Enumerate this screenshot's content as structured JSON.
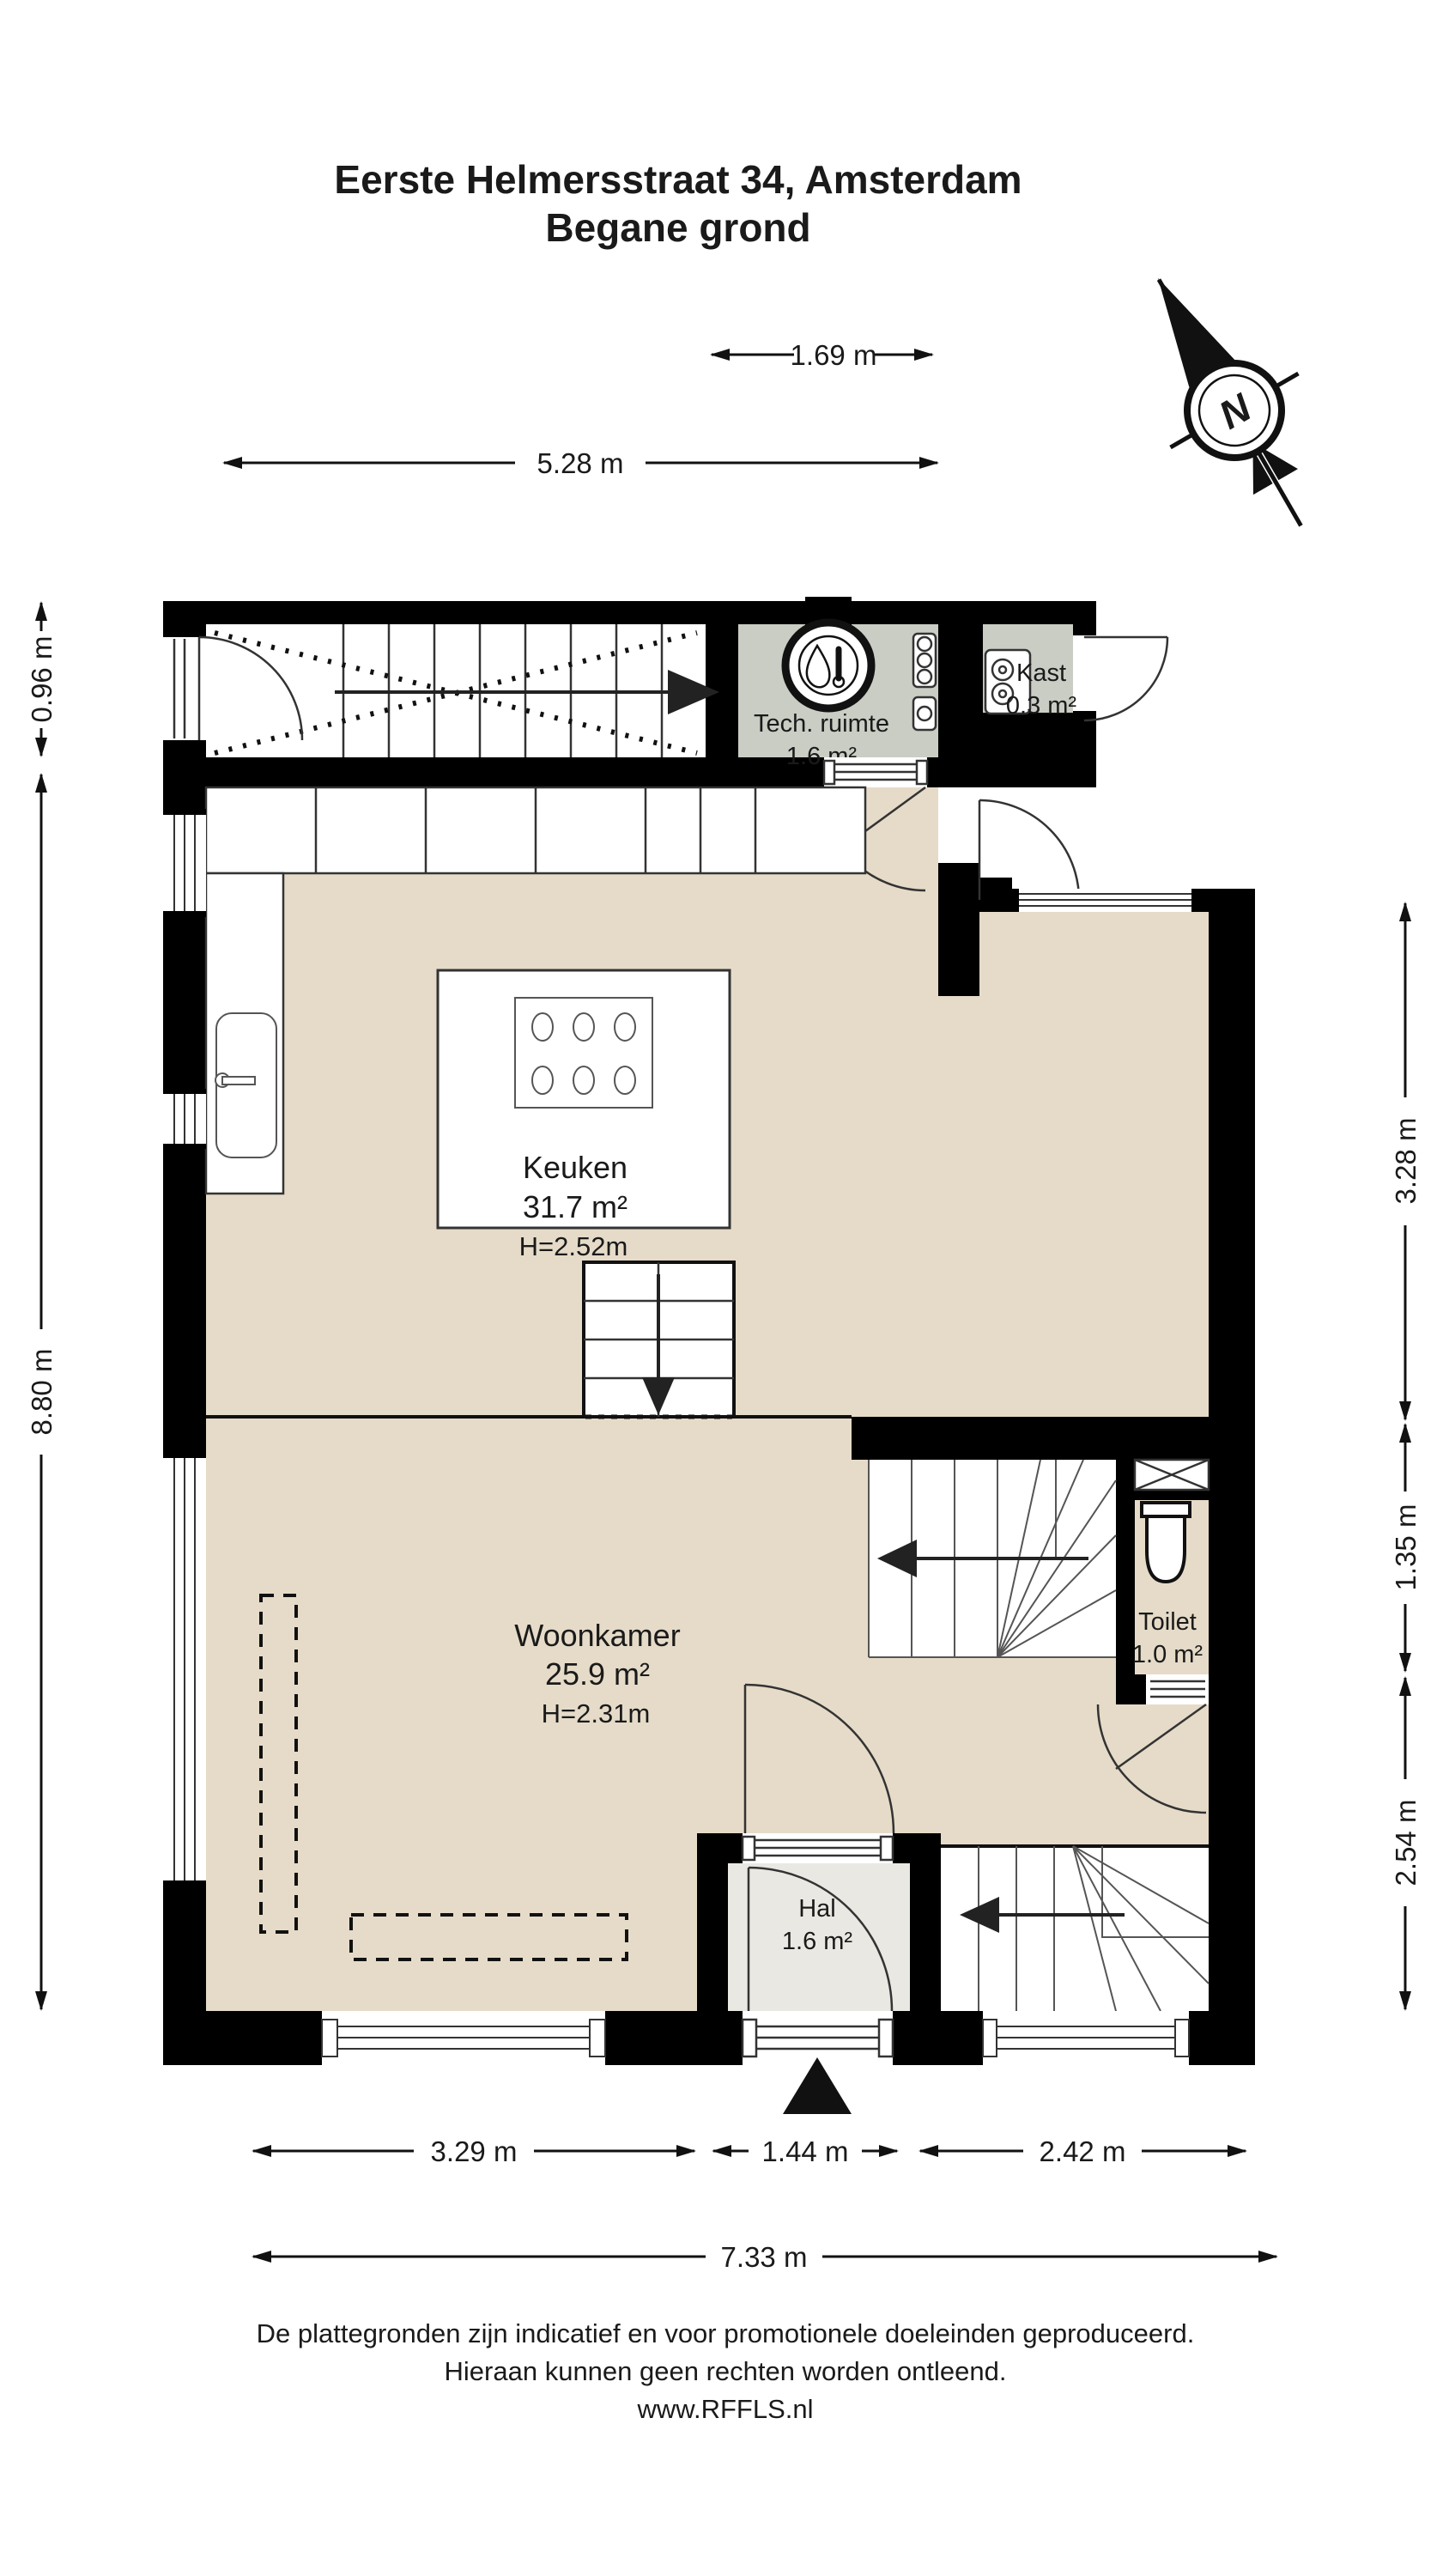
{
  "title": {
    "line1": "Eerste Helmersstraat 34, Amsterdam",
    "line2": "Begane grond"
  },
  "compass": {
    "north_label": "N"
  },
  "rooms": {
    "keuken": {
      "name": "Keuken",
      "area": "31.7 m²",
      "ceiling": "H=2.52m"
    },
    "woonkamer": {
      "name": "Woonkamer",
      "area": "25.9 m²",
      "ceiling": "H=2.31m"
    },
    "tech": {
      "name": "Tech. ruimte",
      "area": "1.6 m²"
    },
    "kast": {
      "name": "Kast",
      "area": "0.3 m²"
    },
    "toilet": {
      "name": "Toilet",
      "area": "1.0 m²"
    },
    "hal": {
      "name": "Hal",
      "area": "1.6 m²"
    }
  },
  "dimensions": {
    "top_kast": "1.69 m",
    "top_width": "5.28 m",
    "left_entry": "0.96 m",
    "left_height": "8.80 m",
    "right_upper": "3.28 m",
    "right_toilet": "1.35 m",
    "right_lower": "2.54 m",
    "bottom_left": "3.29 m",
    "bottom_hal": "1.44 m",
    "bottom_right": "2.42 m",
    "bottom_total": "7.33 m"
  },
  "footer": {
    "line1": "De plattegronden zijn indicatief en voor promotionele doeleinden geproduceerd.",
    "line2": "Hieraan kunnen geen rechten worden ontleend.",
    "line3": "www.RFFLS.nl"
  },
  "colors": {
    "wall": "#000000",
    "floor_main": "#e5dbc8",
    "floor_service": "#c9cdc4",
    "floor_hal": "#eae8e3",
    "line": "#333333"
  }
}
